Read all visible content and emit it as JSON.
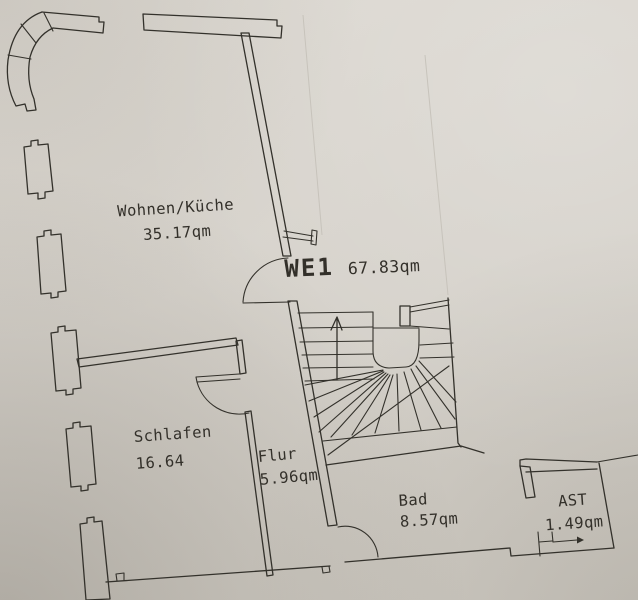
{
  "plan": {
    "unit": {
      "label": "WE1",
      "area": "67.83qm"
    },
    "rooms": [
      {
        "name": "Wohnen/Küche",
        "area": "35.17qm"
      },
      {
        "name": "Schlafen",
        "area": "16.64"
      },
      {
        "name": "Flur",
        "area": "5.96qm"
      },
      {
        "name": "Bad",
        "area": "8.57qm"
      },
      {
        "name": "AST",
        "area": "1.49qm"
      }
    ],
    "colors": {
      "paper": "#d6d2cb",
      "ink": "#33312b"
    },
    "stair_direction_marker": "up-arrow",
    "entry_direction_marker": "right-arrow"
  }
}
